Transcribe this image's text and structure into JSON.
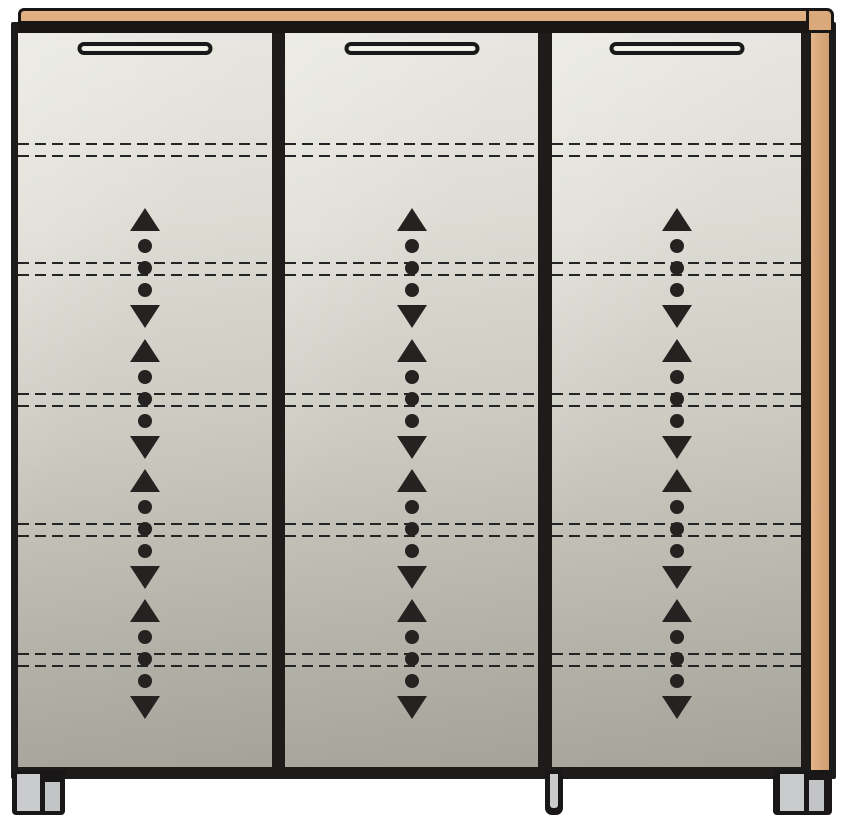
{
  "diagram": {
    "name": "three-door cabinet technical front view",
    "type": "furniture-line-drawing",
    "background": "#ffffff",
    "colors": {
      "outline": "#1e1b1b",
      "wood": "#d9a97c",
      "door_panel_light": "#e8e7e0",
      "door_panel_dark": "#a4a399",
      "symbol_black": "#242322",
      "foot_gray": "#c9cbcd"
    },
    "top_panel": {
      "label": "wood-top-panel"
    },
    "side_panel": {
      "label": "wood-side-panel-right"
    },
    "door_top": 33,
    "door_height": 734,
    "doors": [
      {
        "label": "left-door",
        "left": 18,
        "width": 254
      },
      {
        "label": "center-door",
        "left": 285,
        "width": 253
      },
      {
        "label": "right-door",
        "left": 552,
        "width": 249
      }
    ],
    "handle": {
      "width": 135,
      "height": 13,
      "top": 9
    },
    "shelf_lines": {
      "style": "dashed",
      "pair_tops": [
        110,
        229,
        360,
        490,
        620
      ],
      "pair_gap": 12
    },
    "adjustable_shelf_symbols": {
      "centers": [
        235,
        366,
        496,
        626
      ],
      "glyphs": [
        "arrow-up",
        "dot",
        "dot",
        "dot",
        "arrow-down"
      ]
    },
    "feet": [
      {
        "label": "left-foot"
      },
      {
        "label": "middle-foot"
      },
      {
        "label": "right-foot"
      }
    ]
  }
}
